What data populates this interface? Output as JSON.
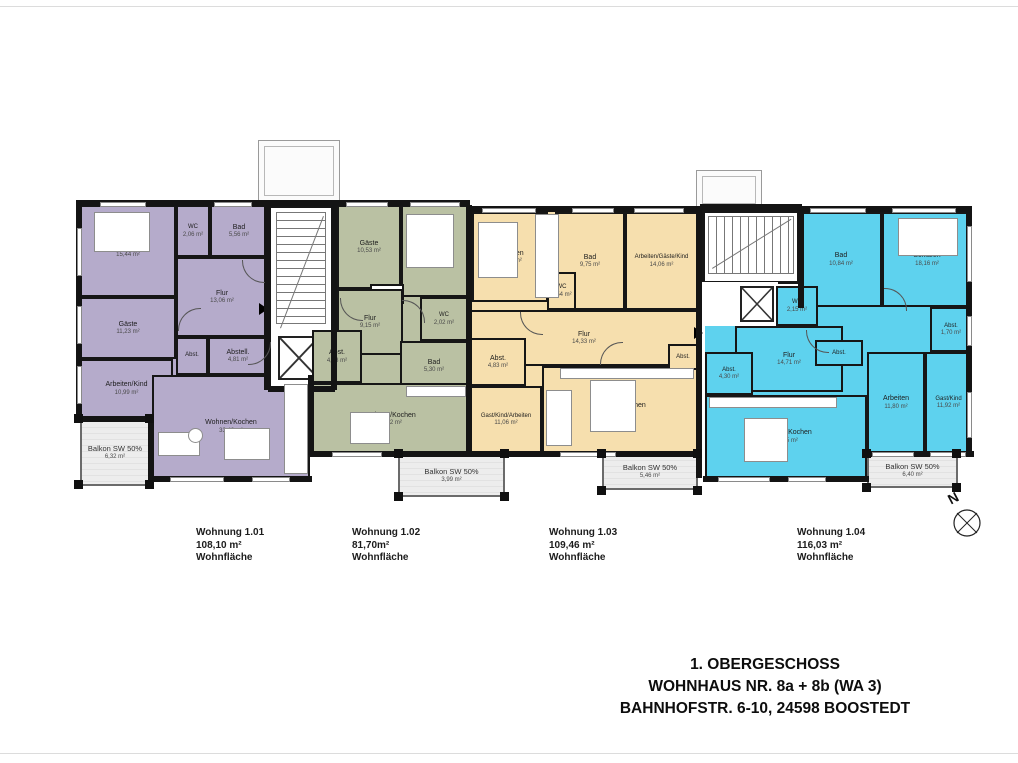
{
  "page": {
    "north_label": "N",
    "title_block": {
      "line1": "1. OBERGESCHOSS",
      "line2": "WOHNHAUS NR. 8a + 8b (WA 3)",
      "line3": "BAHNHOFSTR. 6-10, 24598 BOOSTEDT"
    }
  },
  "apartments": [
    {
      "id": "1.01",
      "color": "#b5abcb",
      "label": {
        "name": "Wohnung 1.01",
        "area": "108,10 m²",
        "note": "Wohnfläche"
      },
      "rooms": [
        {
          "name": "Schlafen",
          "area": "15,44 m²"
        },
        {
          "name": "WC",
          "area": "2,06 m²"
        },
        {
          "name": "Bad",
          "area": "5,56 m²"
        },
        {
          "name": "Flur",
          "area": "13,06 m²"
        },
        {
          "name": "Gäste",
          "area": "11,23 m²"
        },
        {
          "name": "Abst.",
          "area": ""
        },
        {
          "name": "Abstell.",
          "area": "4,81 m²"
        },
        {
          "name": "Arbeiten/Kind",
          "area": "10,99 m²"
        },
        {
          "name": "Wohnen/Kochen",
          "area": "33,48 m²"
        },
        {
          "name": "Balkon SW 50%",
          "area": "6,32 m²"
        }
      ]
    },
    {
      "id": "1.02",
      "color": "#bac1a3",
      "label": {
        "name": "Wohnung 1.02",
        "area": "81,70m²",
        "note": "Wohnfläche"
      },
      "rooms": [
        {
          "name": "Gäste",
          "area": "10,53 m²"
        },
        {
          "name": "Schlafen",
          "area": "15,20 m²"
        },
        {
          "name": "Abst.",
          "area": ""
        },
        {
          "name": "Flur",
          "area": "9,15 m²"
        },
        {
          "name": "WC",
          "area": "2,02 m²"
        },
        {
          "name": "Abst.",
          "area": "4,88 m²"
        },
        {
          "name": "Bad",
          "area": "5,30 m²"
        },
        {
          "name": "Wohnen/Kochen",
          "area": "25,92 m²"
        },
        {
          "name": "Balkon SW 50%",
          "area": "3,99 m²"
        }
      ]
    },
    {
      "id": "1.03",
      "color": "#f6dfae",
      "label": {
        "name": "Wohnung 1.03",
        "area": "109,46 m²",
        "note": "Wohnfläche"
      },
      "rooms": [
        {
          "name": "Schlafen",
          "area": "15,03 m²"
        },
        {
          "name": "Bad",
          "area": "9,75 m²"
        },
        {
          "name": "WC",
          "area": "1,54 m²"
        },
        {
          "name": "Arbeiten/Gäste/Kind",
          "area": "14,06 m²"
        },
        {
          "name": "Flur",
          "area": "14,33 m²"
        },
        {
          "name": "Abst.",
          "area": "4,83 m²"
        },
        {
          "name": "Gast/Kind/Arbeiten",
          "area": "11,06 m²"
        },
        {
          "name": "Wohnen/Kochen",
          "area": "32,20 m²"
        },
        {
          "name": "Abst.",
          "area": ""
        },
        {
          "name": "Balkon SW 50%",
          "area": "5,46 m²"
        }
      ]
    },
    {
      "id": "1.04",
      "color": "#5ed2ee",
      "label": {
        "name": "Wohnung 1.04",
        "area": "116,03 m²",
        "note": "Wohnfläche"
      },
      "rooms": [
        {
          "name": "Bad",
          "area": "10,84 m²"
        },
        {
          "name": "Schlafen",
          "area": "18,16 m²"
        },
        {
          "name": "WC",
          "area": "2,15 m²"
        },
        {
          "name": "Flur",
          "area": "14,71 m²"
        },
        {
          "name": "Abst.",
          "area": "1,70 m²"
        },
        {
          "name": "Abst.",
          "area": ""
        },
        {
          "name": "Abst.",
          "area": "4,30 m²"
        },
        {
          "name": "Wohnen/Kochen",
          "area": "34,25 m²"
        },
        {
          "name": "Arbeiten",
          "area": "11,80 m²"
        },
        {
          "name": "Gast/Kind",
          "area": "11,92 m²"
        },
        {
          "name": "Balkon SW 50%",
          "area": "6,40 m²"
        }
      ]
    }
  ]
}
